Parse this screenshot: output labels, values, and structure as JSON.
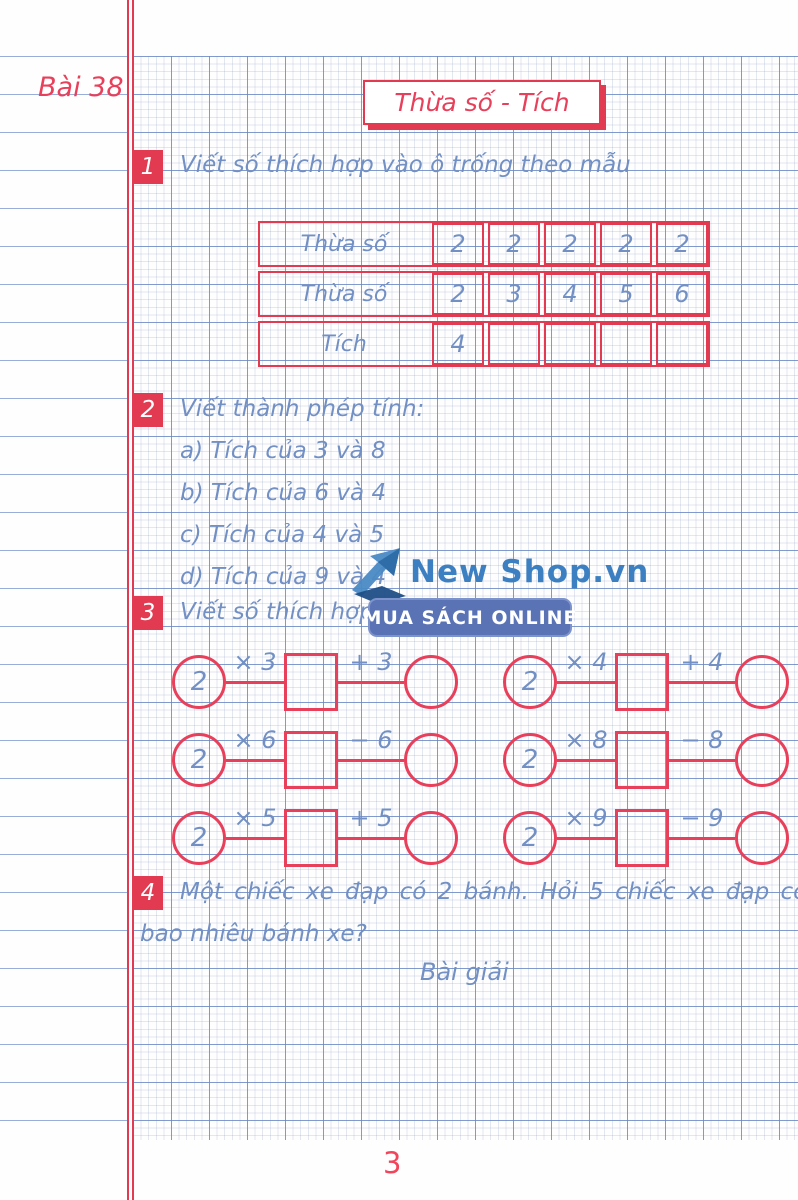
{
  "page": {
    "lesson_label": "Bài 38",
    "title": "Thừa số - Tích",
    "page_number": "3"
  },
  "exercise1": {
    "number": "1",
    "heading": "Viết số thích hợp vào ô trống theo mẫu",
    "table": {
      "rows": [
        {
          "label": "Thừa số",
          "cells": [
            "2",
            "2",
            "2",
            "2",
            "2"
          ]
        },
        {
          "label": "Thừa số",
          "cells": [
            "2",
            "3",
            "4",
            "5",
            "6"
          ]
        },
        {
          "label": "Tích",
          "cells": [
            "4",
            "",
            "",
            "",
            ""
          ]
        }
      ]
    }
  },
  "exercise2": {
    "number": "2",
    "heading": "Viết thành phép tính:",
    "items": [
      "a) Tích của 3 và 8",
      "b) Tích của 6 và 4",
      "c) Tích của 4 và 5",
      "d) Tích của 9 và 4"
    ]
  },
  "exercise3": {
    "number": "3",
    "heading": "Viết số thích hợp",
    "rows": [
      {
        "groups": [
          {
            "value": "2",
            "op1": "× 3",
            "op2": "+ 3"
          },
          {
            "value": "2",
            "op1": "× 4",
            "op2": "+ 4"
          }
        ]
      },
      {
        "groups": [
          {
            "value": "2",
            "op1": "× 6",
            "op2": "− 6"
          },
          {
            "value": "2",
            "op1": "× 8",
            "op2": "− 8"
          }
        ]
      },
      {
        "groups": [
          {
            "value": "2",
            "op1": "× 5",
            "op2": "+ 5"
          },
          {
            "value": "2",
            "op1": "× 9",
            "op2": "− 9"
          }
        ]
      }
    ]
  },
  "exercise4": {
    "number": "4",
    "line1": "Một chiếc xe đạp có 2 bánh. Hỏi 5 chiếc xe đạp có tất cả",
    "line2": "bao nhiêu bánh xe?",
    "solution_label": "Bài giải"
  },
  "watermark": {
    "brand": "New Shop.vn",
    "banner": "MUA SÁCH ONLINE"
  },
  "colors": {
    "accent_red": "#e23a50",
    "ink_blue": "#7290c4",
    "logo_blue": "#3d80c2",
    "banner_blue": "#5a73b5"
  }
}
